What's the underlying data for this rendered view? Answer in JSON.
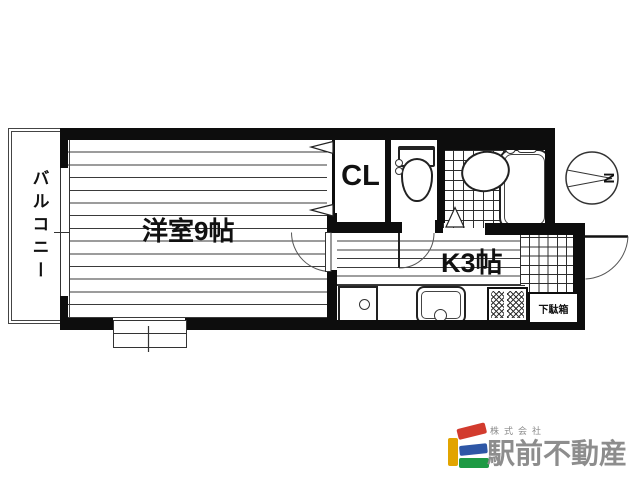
{
  "plan": {
    "balcony_label": "バルコニー",
    "western_room_label": "洋室9帖",
    "closet_label": "CL",
    "kitchen_label": "K3帖",
    "shoe_cabinet_label": "下駄箱",
    "compass_label": "N"
  },
  "logo": {
    "company_type": "株式会社",
    "company_name": "駅前不動産",
    "text_color": "#8d8d8d",
    "mark_colors": {
      "yellow": "#e2a400",
      "red": "#d23b2e",
      "blue": "#2e57a6",
      "green": "#1e9a44"
    }
  }
}
